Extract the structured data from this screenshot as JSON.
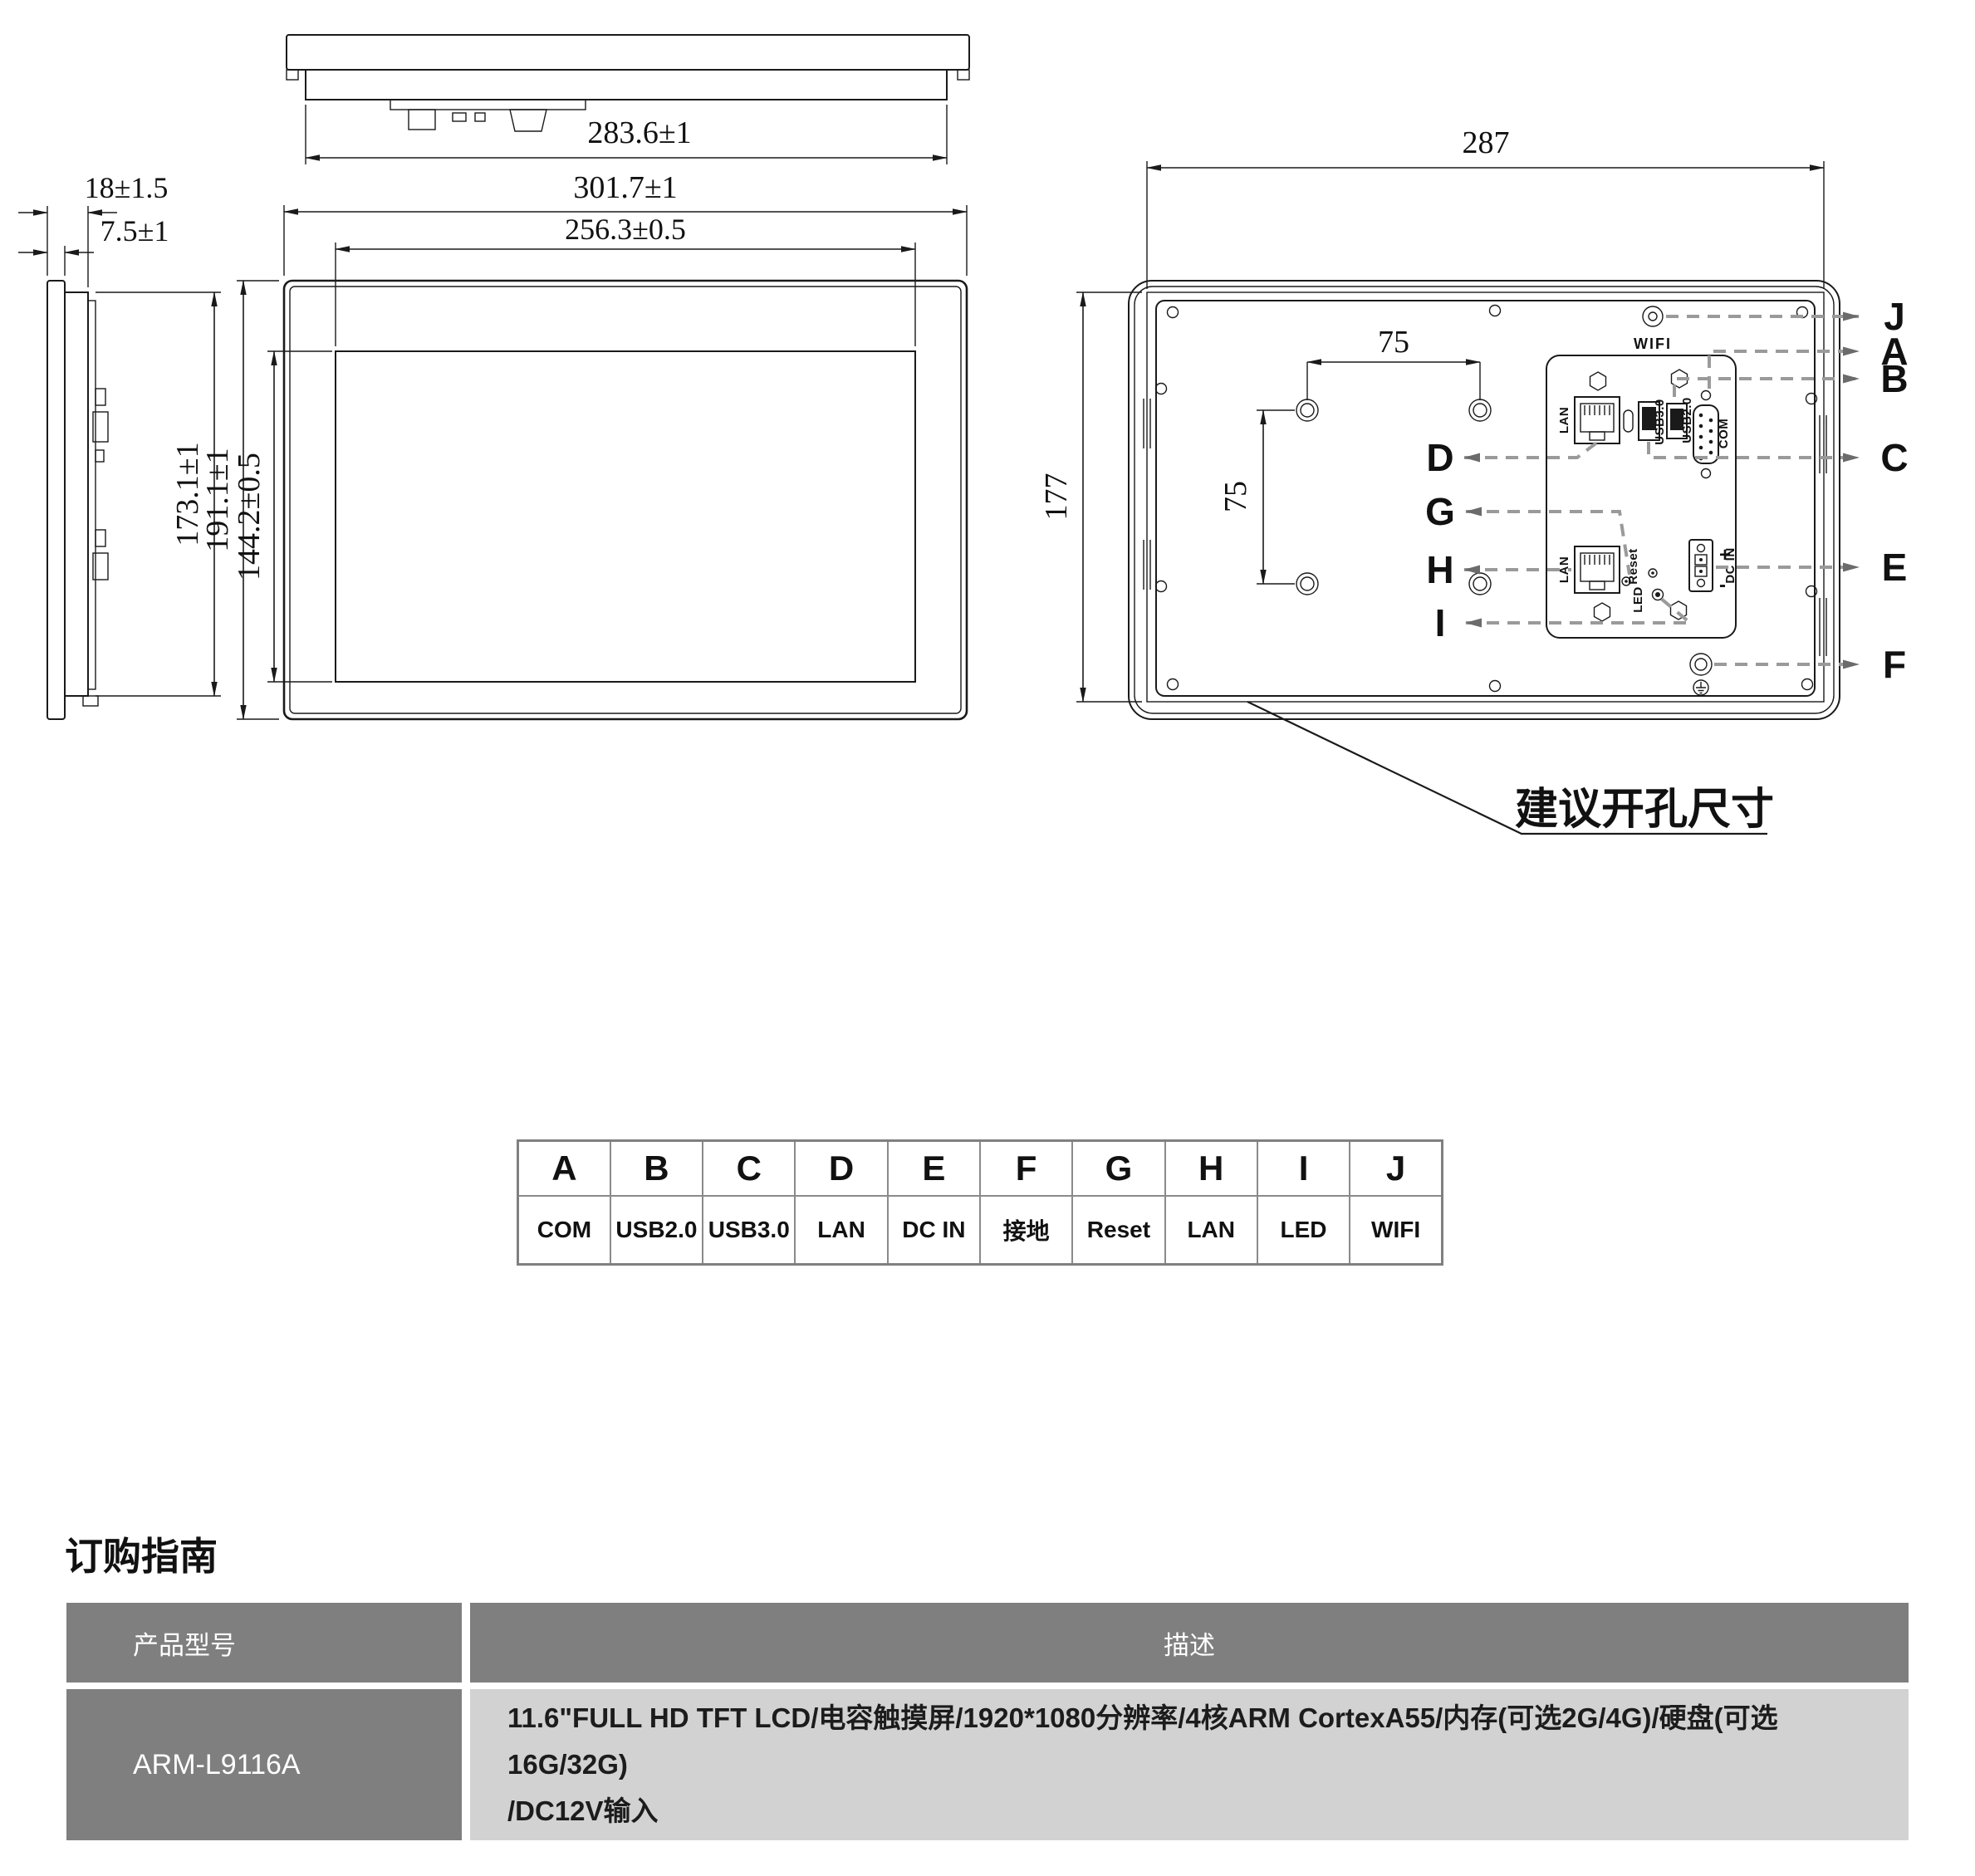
{
  "colors": {
    "line": "#1a1a1a",
    "leader": "#9a9a9a",
    "table_border": "#8a8a8a",
    "order_header_bg": "#7f7f7f",
    "order_desc_bg": "#d2d2d2"
  },
  "top_view": {
    "dim_width": "283.6±1"
  },
  "side_view": {
    "dim_depth": "18±1.5",
    "dim_bezel_depth": "7.5±1",
    "dim_body_height": "173.1±1"
  },
  "front_view": {
    "dim_outer_width": "301.7±1",
    "dim_active_width": "256.3±0.5",
    "dim_outer_height": "191.1±1",
    "dim_active_height": "144.2±0.5"
  },
  "back_view": {
    "dim_cutout_width": "287",
    "dim_cutout_height": "177",
    "dim_vesa_horizontal": "75",
    "dim_vesa_vertical": "75",
    "cutout_note": "建议开孔尺寸",
    "port_labels": {
      "wifi": "WIFI",
      "lan_top": "LAN",
      "usb3": "USB3.0",
      "usb2": "USB2.0",
      "com": "COM",
      "lan_bottom": "LAN",
      "reset": "Reset",
      "led": "LED",
      "dc_in": "DC IN",
      "dc_plus": "+",
      "dc_minus": "-"
    },
    "callouts": {
      "right": [
        "J",
        "A",
        "B",
        "C",
        "E",
        "F"
      ],
      "left": [
        "D",
        "G",
        "H",
        "I"
      ]
    }
  },
  "port_table": {
    "cols": [
      {
        "letter": "A",
        "value": "COM"
      },
      {
        "letter": "B",
        "value": "USB2.0"
      },
      {
        "letter": "C",
        "value": "USB3.0"
      },
      {
        "letter": "D",
        "value": "LAN"
      },
      {
        "letter": "E",
        "value": "DC IN"
      },
      {
        "letter": "F",
        "value": "接地"
      },
      {
        "letter": "G",
        "value": "Reset"
      },
      {
        "letter": "H",
        "value": "LAN"
      },
      {
        "letter": "I",
        "value": "LED"
      },
      {
        "letter": "J",
        "value": "WIFI"
      }
    ]
  },
  "order_guide": {
    "heading": "订购指南",
    "col_model": "产品型号",
    "col_desc": "描述",
    "model": "ARM-L9116A",
    "desc_line1": "11.6\"FULL HD TFT LCD/电容触摸屏/1920*1080分辨率/4核ARM CortexA55/内存(可选2G/4G)/硬盘(可选16G/32G)",
    "desc_line2": "/DC12V输入"
  }
}
